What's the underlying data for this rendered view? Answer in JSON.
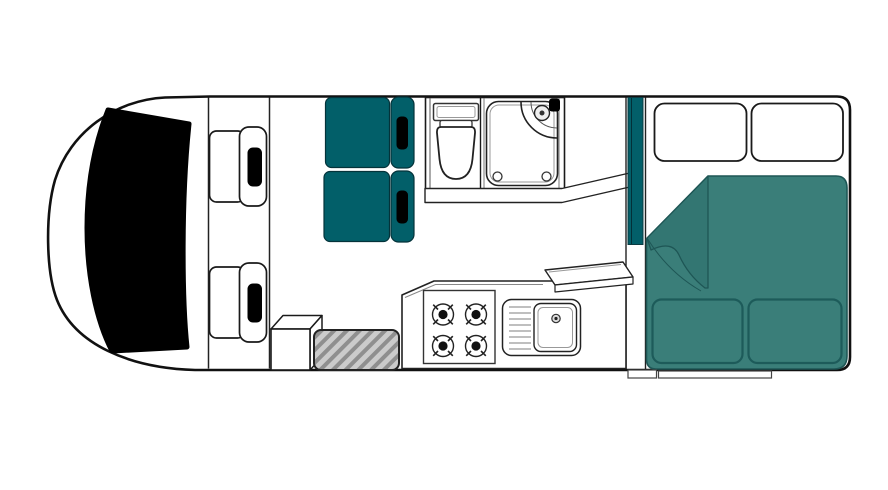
{
  "page": {
    "background": "#ffffff",
    "diagram_type": "motorhome-floorplan-top-view"
  },
  "floorplan": {
    "colors": {
      "outline": "#111111",
      "black": "#000000",
      "teal_dark": "#025F69",
      "teal_bed": "#3A7E79",
      "teal_fold": "#337672",
      "teal_border": "#1E5655",
      "cushion_border": "#1D5B5A",
      "mat_fill": "#CBCBCB",
      "mat_stripe": "#8F8F8F",
      "white": "#FFFFFF"
    },
    "components": [
      "vehicle-body",
      "windshield",
      "driver-seat",
      "passenger-seat",
      "dinette-seat-front",
      "dinette-seat-rear",
      "bathroom",
      "toilet",
      "shower-tray",
      "shower-unit",
      "wardrobe-partition",
      "kitchen-counter",
      "stove-4-burner",
      "sink-with-drainer",
      "raised-shelf",
      "storage-box",
      "entry-mat",
      "rear-bed",
      "duvet-fold",
      "bed-cushion-left",
      "bed-cushion-right",
      "overhead-locker-left",
      "overhead-locker-right",
      "entry-step-small",
      "entry-step-wide"
    ]
  }
}
